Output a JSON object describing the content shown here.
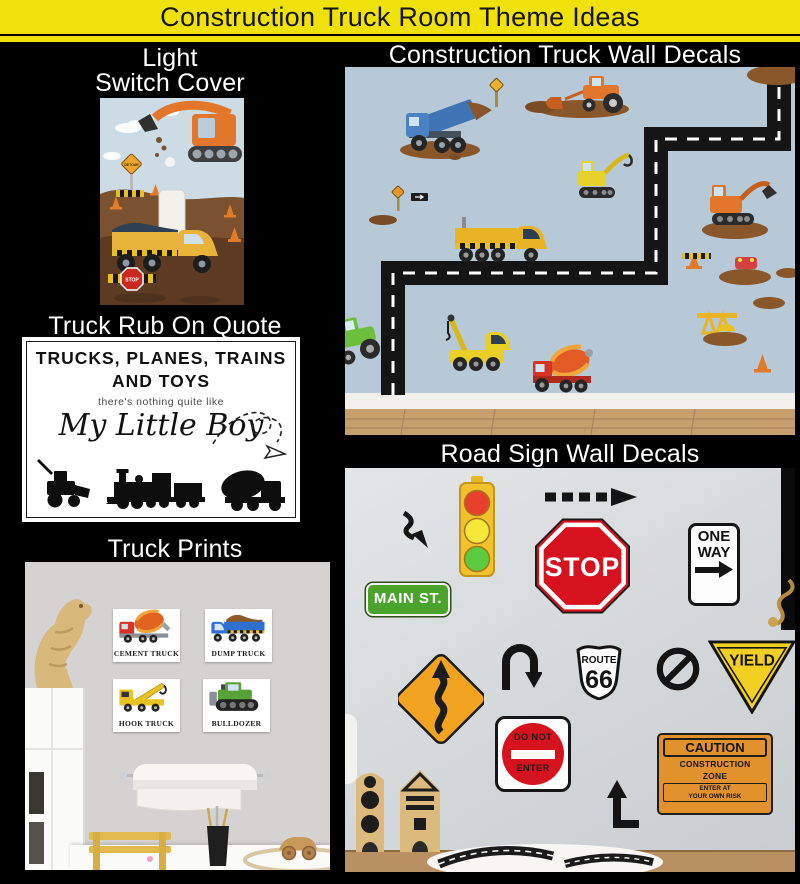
{
  "page": {
    "title": "Construction Truck Room Theme Ideas",
    "colors": {
      "accent_yellow": "#f0e10b",
      "background": "#000000",
      "decal_wall_blue": "#b7c9d6",
      "sign_wall_gray": "#dadde0",
      "stop_red": "#d6121f",
      "main_st_green": "#4aa32a",
      "caution_orange": "#e2922c",
      "yield_yellow": "#f2d023"
    }
  },
  "sections": {
    "light_switch": {
      "label_line1": "Light",
      "label_line2": "Switch Cover",
      "detour_text": "DETOUR",
      "stop_text": "STOP"
    },
    "wall_decals": {
      "label": "Construction Truck Wall Decals"
    },
    "quote": {
      "label": "Truck Rub On Quote",
      "line1": "TRUCKS, PLANES, TRAINS",
      "line2": "AND TOYS",
      "line3": "there's nothing quite like",
      "line4": "My Little Boy"
    },
    "truck_prints": {
      "label": "Truck Prints",
      "prints": [
        {
          "name": "CEMENT TRUCK"
        },
        {
          "name": "DUMP TRUCK"
        },
        {
          "name": "HOOK TRUCK"
        },
        {
          "name": "BULLDOZER"
        }
      ]
    },
    "road_signs": {
      "label": "Road Sign Wall Decals",
      "main_st": "MAIN ST.",
      "stop": "STOP",
      "one_way_line1": "ONE",
      "one_way_line2": "WAY",
      "route_line1": "ROUTE",
      "route_line2": "66",
      "yield": "YIELD",
      "do_not_enter_line1": "DO NOT",
      "do_not_enter_line2": "ENTER",
      "caution_title": "CAUTION",
      "caution_line1": "CONSTRUCTION",
      "caution_line2": "ZONE",
      "caution_line3": "ENTER AT",
      "caution_line4": "YOUR OWN RISK"
    }
  }
}
